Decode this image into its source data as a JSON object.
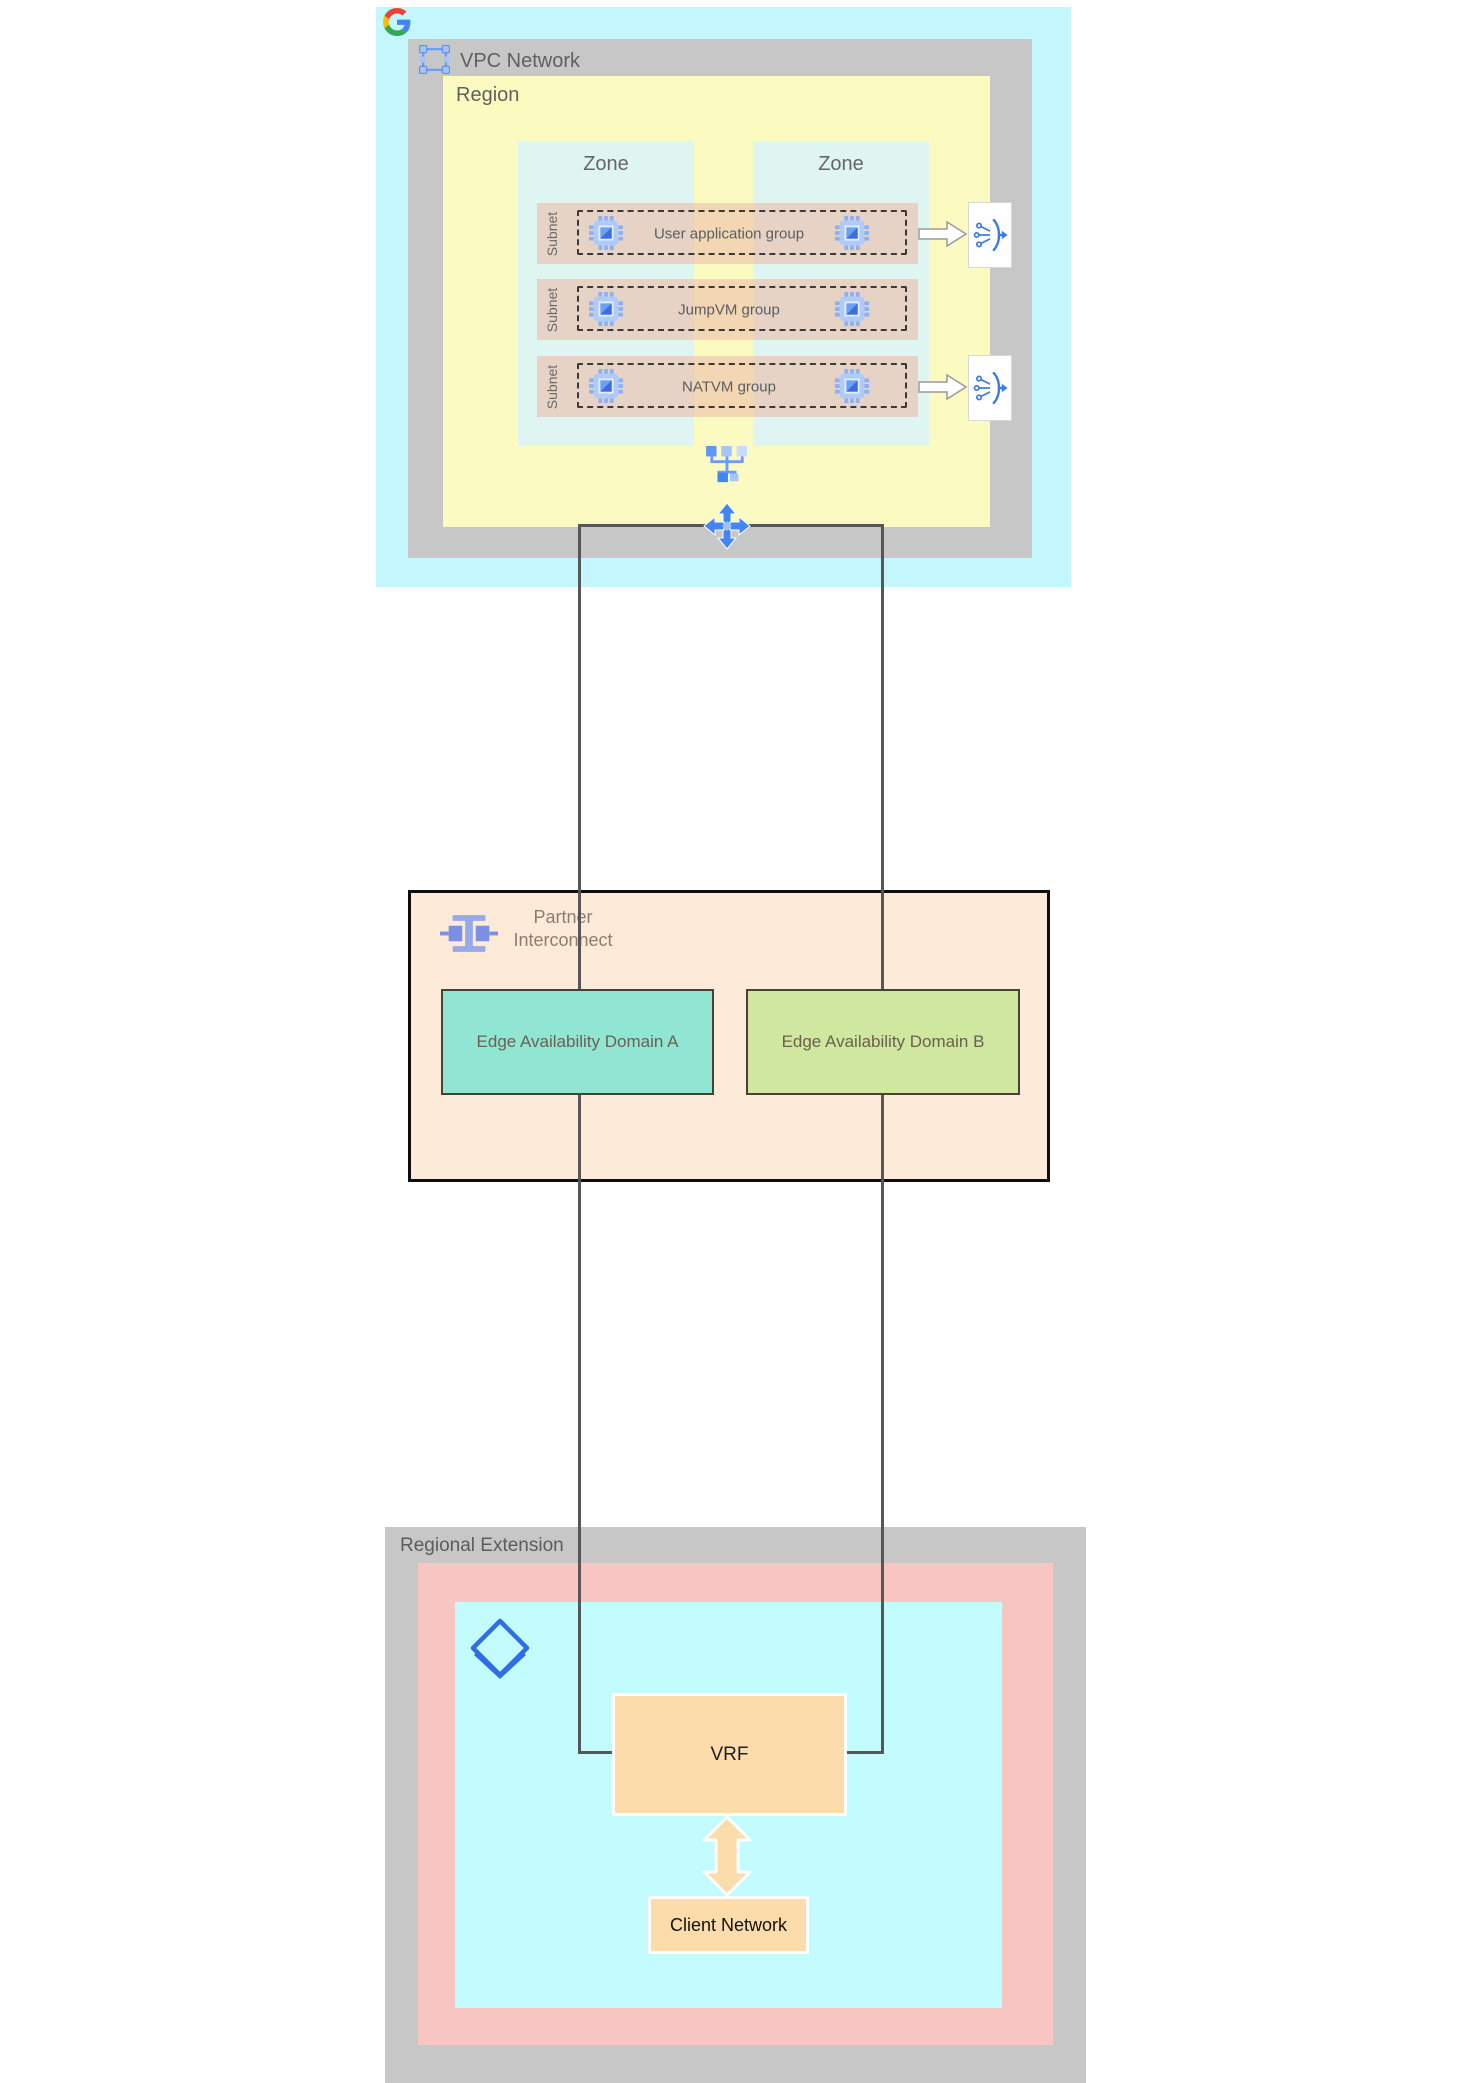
{
  "vpc": {
    "title": "VPC Network",
    "region_label": "Region",
    "zone_labels": [
      "Zone",
      "Zone"
    ],
    "subnets": [
      {
        "sidebar_label": "Subnet",
        "group": "User application group",
        "has_load_balancer": true
      },
      {
        "sidebar_label": "Subnet",
        "group": "JumpVM group",
        "has_load_balancer": false
      },
      {
        "sidebar_label": "Subnet",
        "group": "NATVM group",
        "has_load_balancer": true
      }
    ]
  },
  "interconnect": {
    "title_line1": "Partner",
    "title_line2": "Interconnect",
    "domains": [
      {
        "label": "Edge Availability Domain A",
        "color": "#90e5d3"
      },
      {
        "label": "Edge Availability Domain B",
        "color": "#cfe79e"
      }
    ]
  },
  "regional_extension": {
    "title": "Regional Extension",
    "vrf_label": "VRF",
    "client_network_label": "Client Network"
  },
  "icons": {
    "google_logo": "google-g-logo",
    "vpc": "vpc-network-icon",
    "vm": "vm-instance-chip-icon",
    "load_balancer": "load-balancer-icon",
    "network": "network-hub-icon",
    "routes": "four-way-arrows-icon",
    "partner_interconnect": "interconnect-icon",
    "cloud_router": "cloud-router-icon"
  },
  "colors": {
    "vpc_outer_bg": "#c3f6fd",
    "band_gray": "#c7c7c7",
    "region_bg": "#fbfbc1",
    "zone_bg": "#def5f1",
    "subnet_row_overlay": "rgba(238,190,170,0.62)",
    "interconnect_bg": "#fdead9",
    "edge_a_bg": "#90e5d3",
    "edge_b_bg": "#cfe79e",
    "regional_pink_bg": "#f7c5c2",
    "regional_cyan_bg": "#c3fcff",
    "vrf_bg": "#fcdcaa",
    "connector_line": "#575757",
    "icon_blue": "#4285f4",
    "interconnect_icon_blue": "#8da2e8"
  }
}
